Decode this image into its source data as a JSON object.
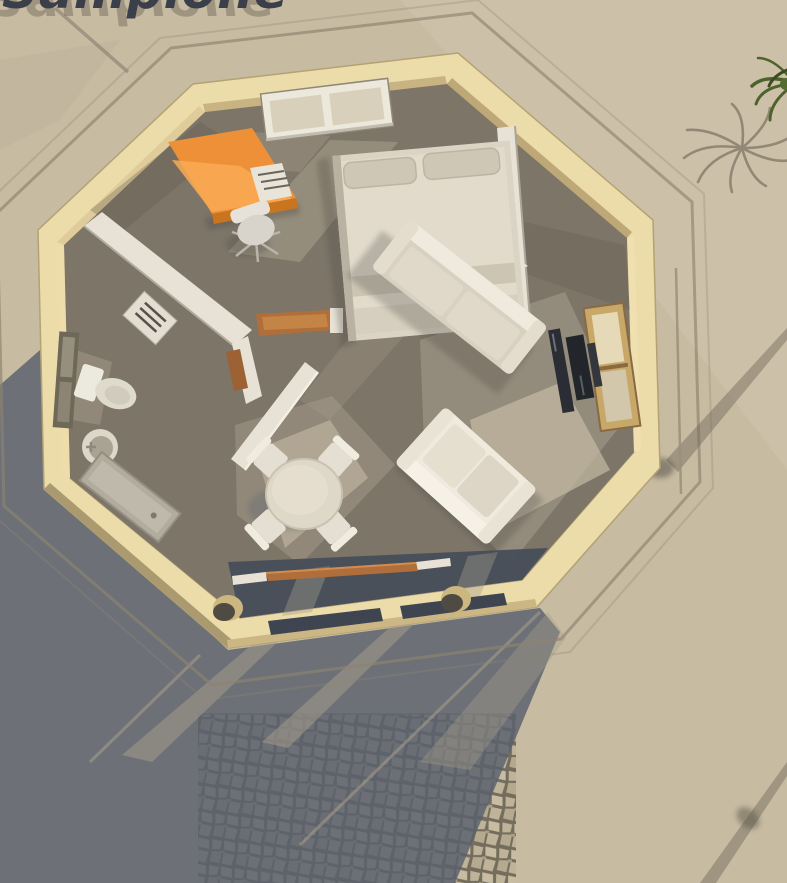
{
  "title": {
    "text": "Sampione"
  },
  "colors": {
    "sand": "#c7bba2",
    "sandLight": "#d4c8b0",
    "shadow": "#59606e",
    "wallTop": "#ecdcaa",
    "wallInnerDark": "#c9b383",
    "wallInnerLit": "#f0e0b0",
    "wallOuterDark": "#ab9a70",
    "floor": "#7d7568",
    "floorDark": "#5e584c",
    "floorLight": "#a59c8b",
    "floorBright": "#c4baa4",
    "partition": "#e7e2d5",
    "desk": "#ee9038",
    "deskLit": "#f9ab55",
    "deskDark": "#c9751f",
    "wood": "#b06f3a",
    "bed": "#dbd4c5",
    "pillow": "#cfc7b6",
    "sofa": "#d8d1c1",
    "cushion": "#efeadd",
    "tv": "#22262b",
    "porch": "#474e5a",
    "cobble": "#bfb49a",
    "cobbleJoint": "#746c5c",
    "palm": "#4e622c",
    "curb": "#8d8470",
    "lamp": "#9a917c",
    "titleText": "#3b3f49",
    "titleShadow": "#7d7566"
  },
  "scene": {
    "description": "Top-down 3D rendering of an octagonal one-room house with porch",
    "objects": [
      "octagonal-house",
      "double-bed",
      "orange-desk",
      "office-chair",
      "long-sofa",
      "loveseat",
      "tv-panel",
      "dining-table",
      "dining-chairs",
      "toilet",
      "round-sink",
      "shower-base",
      "kitchen-counter",
      "kitchen-appliance",
      "entry-door",
      "bathroom-door",
      "porch-columns",
      "sliding-door-track",
      "palm-tree",
      "lamp-post",
      "stone-path"
    ]
  }
}
